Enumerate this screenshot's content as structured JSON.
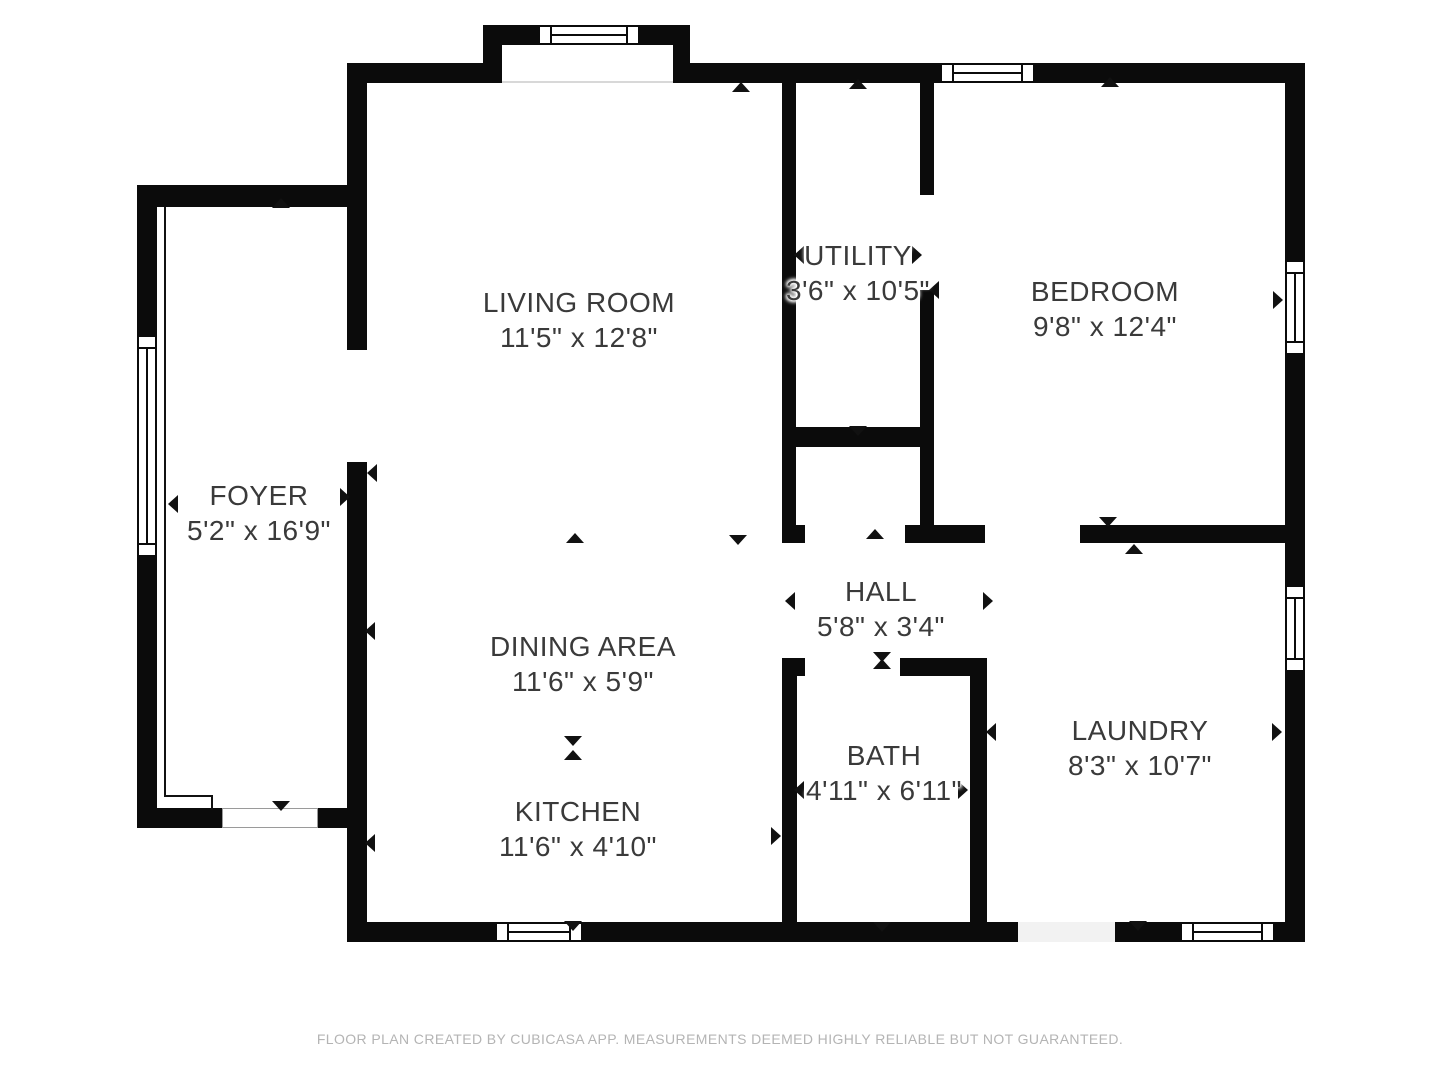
{
  "meta": {
    "background_color": "#ffffff",
    "wall_color": "#0b0b0b",
    "label_color": "#3a3a3a",
    "footer_color": "#b4b4b4"
  },
  "footer": {
    "text": "FLOOR PLAN CREATED BY CUBICASA APP. MEASUREMENTS DEEMED HIGHLY RELIABLE BUT NOT GUARANTEED."
  },
  "rooms": [
    {
      "id": "living-room",
      "name": "LIVING ROOM",
      "dims": "11'5\" x 12'8\"",
      "cx": 579,
      "name_y": 302,
      "dims_y": 337
    },
    {
      "id": "utility",
      "name": "UTILITY",
      "dims": "3'6\" x 10'5\"",
      "cx": 858,
      "name_y": 255,
      "dims_y": 290
    },
    {
      "id": "bedroom",
      "name": "BEDROOM",
      "dims": "9'8\" x 12'4\"",
      "cx": 1105,
      "name_y": 291,
      "dims_y": 326
    },
    {
      "id": "foyer",
      "name": "FOYER",
      "dims": "5'2\" x 16'9\"",
      "cx": 259,
      "name_y": 495,
      "dims_y": 530
    },
    {
      "id": "hall",
      "name": "HALL",
      "dims": "5'8\" x 3'4\"",
      "cx": 881,
      "name_y": 591,
      "dims_y": 626
    },
    {
      "id": "dining-area",
      "name": "DINING AREA",
      "dims": "11'6\" x 5'9\"",
      "cx": 583,
      "name_y": 646,
      "dims_y": 681
    },
    {
      "id": "laundry",
      "name": "LAUNDRY",
      "dims": "8'3\" x 10'7\"",
      "cx": 1140,
      "name_y": 730,
      "dims_y": 765
    },
    {
      "id": "bath",
      "name": "BATH",
      "dims": "4'11\" x 6'11\"",
      "cx": 884,
      "name_y": 755,
      "dims_y": 790
    },
    {
      "id": "kitchen",
      "name": "KITCHEN",
      "dims": "11'6\" x 4'10\"",
      "cx": 578,
      "name_y": 811,
      "dims_y": 846
    }
  ],
  "geometry": {
    "walls": [
      {
        "x": 347,
        "y": 63,
        "w": 938,
        "h": 20
      },
      {
        "x": 483,
        "y": 25,
        "w": 207,
        "h": 58
      },
      {
        "x": 1285,
        "y": 63,
        "w": 20,
        "h": 879
      },
      {
        "x": 347,
        "y": 922,
        "w": 958,
        "h": 20
      },
      {
        "x": 347,
        "y": 63,
        "w": 20,
        "h": 287
      },
      {
        "x": 347,
        "y": 462,
        "w": 20,
        "h": 460
      },
      {
        "x": 137,
        "y": 185,
        "w": 210,
        "h": 22
      },
      {
        "x": 137,
        "y": 185,
        "w": 20,
        "h": 643
      },
      {
        "x": 137,
        "y": 808,
        "w": 85,
        "h": 20
      },
      {
        "x": 318,
        "y": 808,
        "w": 49,
        "h": 20
      },
      {
        "x": 782,
        "y": 83,
        "w": 14,
        "h": 442
      },
      {
        "x": 782,
        "y": 525,
        "w": 23,
        "h": 18
      },
      {
        "x": 920,
        "y": 83,
        "w": 14,
        "h": 112
      },
      {
        "x": 920,
        "y": 290,
        "w": 14,
        "h": 235
      },
      {
        "x": 905,
        "y": 525,
        "w": 80,
        "h": 18
      },
      {
        "x": 796,
        "y": 427,
        "w": 124,
        "h": 20
      },
      {
        "x": 1080,
        "y": 525,
        "w": 205,
        "h": 18
      },
      {
        "x": 782,
        "y": 658,
        "w": 23,
        "h": 18
      },
      {
        "x": 900,
        "y": 658,
        "w": 87,
        "h": 18
      },
      {
        "x": 782,
        "y": 676,
        "w": 15,
        "h": 246
      },
      {
        "x": 970,
        "y": 676,
        "w": 17,
        "h": 246
      }
    ],
    "overlays": [
      {
        "x": 502,
        "y": 45,
        "w": 171,
        "h": 38,
        "fill": "#ffffff"
      },
      {
        "x": 502,
        "y": 81,
        "w": 171,
        "h": 2,
        "fill": "#d8d8d8"
      },
      {
        "x": 222,
        "y": 808,
        "w": 96,
        "h": 20,
        "fill": "#ffffff",
        "border": "1px solid #9a9a9a"
      },
      {
        "x": 1018,
        "y": 922,
        "w": 97,
        "h": 20,
        "fill": "#f2f2f2"
      }
    ],
    "windows": [
      {
        "x": 538,
        "y": 25,
        "w": 102,
        "h": 20,
        "o": "h"
      },
      {
        "x": 940,
        "y": 63,
        "w": 95,
        "h": 20,
        "o": "h"
      },
      {
        "x": 1285,
        "y": 260,
        "w": 20,
        "h": 95,
        "o": "v"
      },
      {
        "x": 1285,
        "y": 585,
        "w": 20,
        "h": 87,
        "o": "v"
      },
      {
        "x": 137,
        "y": 335,
        "w": 20,
        "h": 222,
        "o": "v"
      },
      {
        "x": 495,
        "y": 922,
        "w": 88,
        "h": 20,
        "o": "h"
      },
      {
        "x": 1180,
        "y": 922,
        "w": 95,
        "h": 20,
        "o": "h"
      }
    ],
    "thin_lines": [
      {
        "x": 164,
        "y": 207,
        "w": 2,
        "h": 590,
        "color": "#111111"
      },
      {
        "x": 164,
        "y": 795,
        "w": 49,
        "h": 2,
        "color": "#111111"
      },
      {
        "x": 211,
        "y": 795,
        "w": 2,
        "h": 15,
        "color": "#111111"
      }
    ],
    "arrows": [
      {
        "x": 281,
        "y": 203,
        "d": "up"
      },
      {
        "x": 173,
        "y": 504,
        "d": "left"
      },
      {
        "x": 345,
        "y": 497,
        "d": "right"
      },
      {
        "x": 281,
        "y": 806,
        "d": "down"
      },
      {
        "x": 741,
        "y": 87,
        "d": "up"
      },
      {
        "x": 372,
        "y": 473,
        "d": "left"
      },
      {
        "x": 738,
        "y": 540,
        "d": "down"
      },
      {
        "x": 575,
        "y": 538,
        "d": "up"
      },
      {
        "x": 370,
        "y": 631,
        "d": "left"
      },
      {
        "x": 573,
        "y": 741,
        "d": "down"
      },
      {
        "x": 573,
        "y": 755,
        "d": "up"
      },
      {
        "x": 370,
        "y": 843,
        "d": "left"
      },
      {
        "x": 776,
        "y": 836,
        "d": "right"
      },
      {
        "x": 573,
        "y": 926,
        "d": "down"
      },
      {
        "x": 858,
        "y": 84,
        "d": "up"
      },
      {
        "x": 799,
        "y": 255,
        "d": "left"
      },
      {
        "x": 917,
        "y": 255,
        "d": "right"
      },
      {
        "x": 934,
        "y": 290,
        "d": "left"
      },
      {
        "x": 858,
        "y": 431,
        "d": "down"
      },
      {
        "x": 1110,
        "y": 82,
        "d": "up"
      },
      {
        "x": 1278,
        "y": 300,
        "d": "right"
      },
      {
        "x": 1108,
        "y": 522,
        "d": "down"
      },
      {
        "x": 875,
        "y": 534,
        "d": "up"
      },
      {
        "x": 790,
        "y": 601,
        "d": "left"
      },
      {
        "x": 988,
        "y": 601,
        "d": "right"
      },
      {
        "x": 882,
        "y": 657,
        "d": "down"
      },
      {
        "x": 882,
        "y": 664,
        "d": "up"
      },
      {
        "x": 799,
        "y": 790,
        "d": "left"
      },
      {
        "x": 963,
        "y": 790,
        "d": "right"
      },
      {
        "x": 882,
        "y": 927,
        "d": "down"
      },
      {
        "x": 1134,
        "y": 549,
        "d": "up"
      },
      {
        "x": 991,
        "y": 732,
        "d": "left"
      },
      {
        "x": 1277,
        "y": 732,
        "d": "right"
      },
      {
        "x": 1138,
        "y": 926,
        "d": "down"
      }
    ]
  }
}
